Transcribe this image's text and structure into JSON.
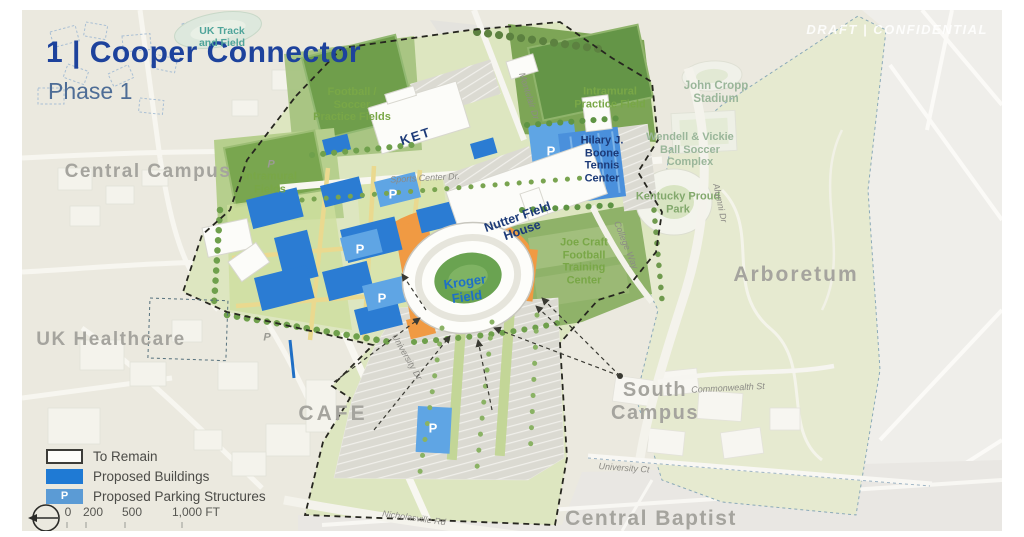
{
  "header": {
    "title": "1 | Cooper Connector",
    "subtitle": "Phase 1",
    "watermark": "DRAFT | CONFIDENTIAL"
  },
  "areas": [
    "Central Campus",
    "UK Healthcare",
    "CAFE",
    "South Campus",
    "Central Baptist",
    "Arboretum"
  ],
  "facilities": [
    "UK Track and Field",
    "Football / Soccer Practice Fields",
    "Intramural Fields",
    "KET",
    "Intramural Practice Field",
    "Hilary J. Boone Tennis Center",
    "Nutter Field House",
    "Kroger Field",
    "Joe Craft Football Training Center",
    "John Cropp Stadium",
    "Wendell & Vickie Ball Soccer Complex",
    "Kentucky Proud Park"
  ],
  "streets": [
    "Montclair Dr",
    "Sports Center Dr.",
    "Alumni Dr",
    "College Way",
    "University Dr",
    "Commonwealth St",
    "University Ct",
    "Nicholasville Rd"
  ],
  "legend": {
    "items": [
      "To Remain",
      "Proposed Buildings",
      "Proposed Parking Structures"
    ]
  },
  "scale": {
    "ticks": [
      "0",
      "200",
      "500",
      "1,000 FT"
    ]
  },
  "symbols": {
    "parking": "P"
  },
  "colors": {
    "title_navy": "#1d429c",
    "proposed_building_blue": "#1f7ad4",
    "parking_structure_blue": "#5b9bd5",
    "connector_orange": "#f09a43",
    "field_green": "#6f9e4b"
  }
}
